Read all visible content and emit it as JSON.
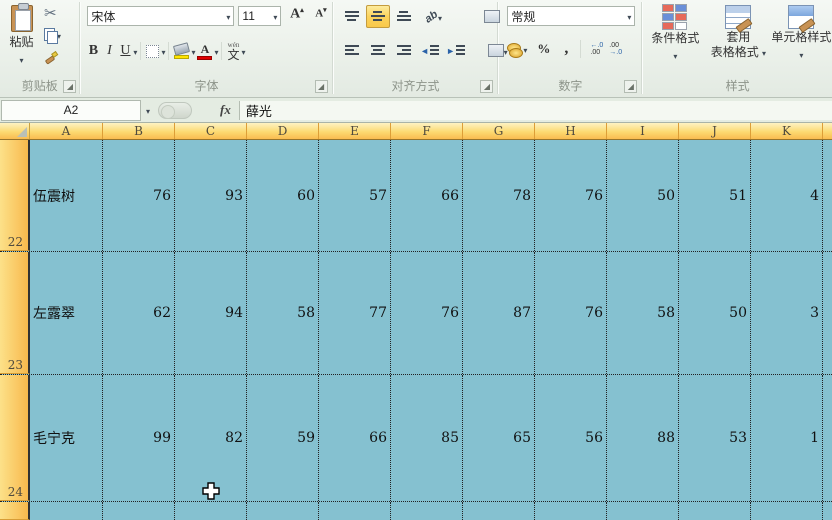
{
  "ribbon": {
    "clipboard": {
      "label": "剪贴板",
      "paste_label": "粘贴"
    },
    "font": {
      "label": "字体",
      "font_name": "宋体",
      "font_size": "11",
      "bold": "B",
      "italic": "I",
      "underline": "U",
      "grow_font": "A",
      "shrink_font": "A",
      "font_color_letter": "A",
      "phonetic_top": "wén",
      "phonetic_char": "文"
    },
    "alignment": {
      "label": "对齐方式",
      "orientation_text": "ab"
    },
    "number": {
      "label": "数字",
      "format_selected": "常规",
      "percent": "%",
      "comma": ",",
      "inc_dec_top": "←.0",
      "inc_dec_bot": ".00",
      "dec_dec_top": ".00",
      "dec_dec_bot": "→.0"
    },
    "styles": {
      "label": "样式",
      "conditional_format": "条件格式",
      "format_table_line1": "套用",
      "format_table_line2": "表格格式",
      "cell_styles": "单元格样式"
    }
  },
  "formula_bar": {
    "name_box": "A2",
    "fx_label": "fx",
    "value": "薛光"
  },
  "grid": {
    "columns": [
      "A",
      "B",
      "C",
      "D",
      "E",
      "F",
      "G",
      "H",
      "I",
      "J",
      "K"
    ],
    "rows": [
      {
        "num": "22",
        "name": "伍震树",
        "values": [
          "76",
          "93",
          "60",
          "57",
          "66",
          "78",
          "76",
          "50",
          "51",
          "4"
        ]
      },
      {
        "num": "23",
        "name": "左露翠",
        "values": [
          "62",
          "94",
          "58",
          "77",
          "76",
          "87",
          "76",
          "58",
          "50",
          "3"
        ]
      },
      {
        "num": "24",
        "name": "毛宁克",
        "values": [
          "99",
          "82",
          "59",
          "66",
          "85",
          "65",
          "56",
          "88",
          "53",
          "1"
        ]
      }
    ]
  },
  "colors": {
    "selection_fill": "#85c1d0",
    "header_selected": "#f9bc50",
    "active_align_button": "#fbd35e"
  }
}
